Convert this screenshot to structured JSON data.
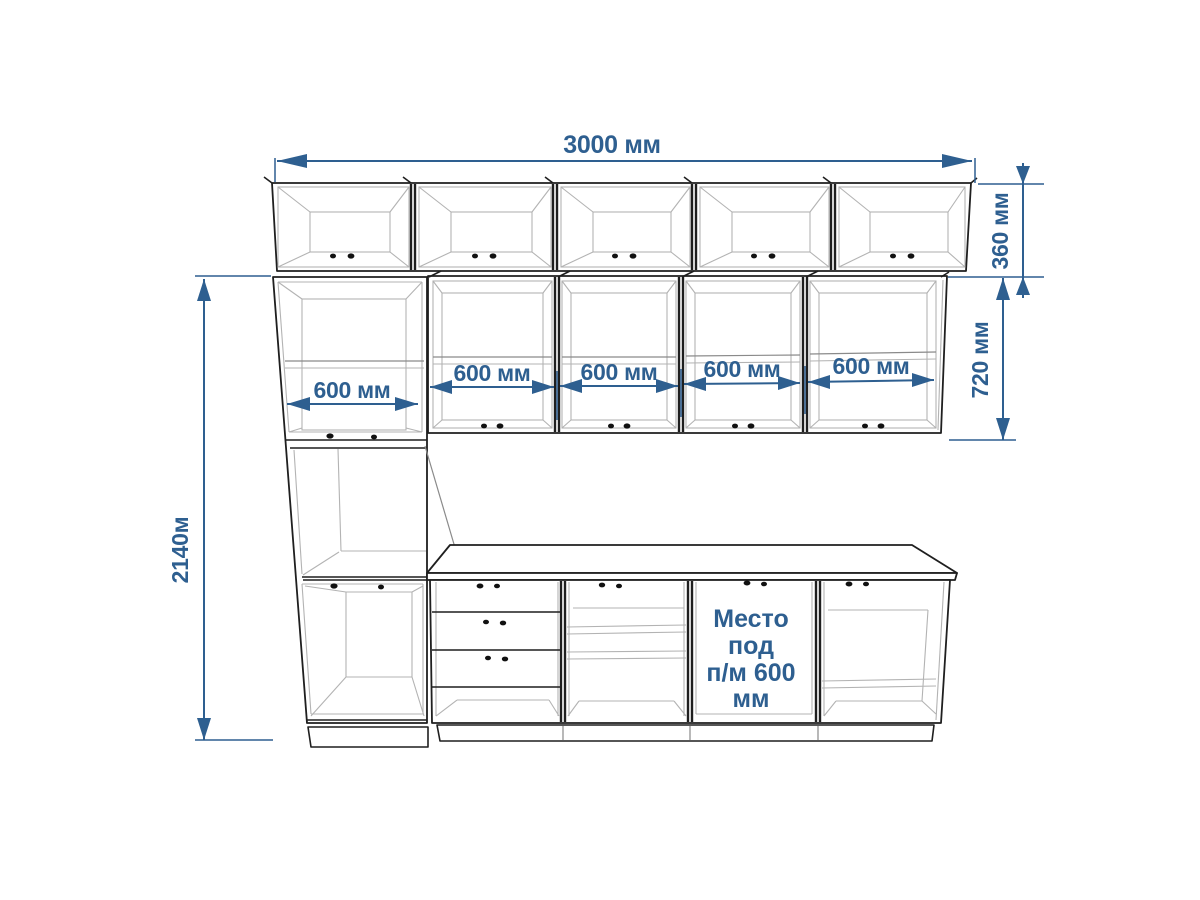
{
  "diagram": {
    "dimensions": {
      "total_width": "3000 мм",
      "upper_cabinet_height": "360 мм",
      "wall_cabinet_height": "720 мм",
      "total_height": "2140м",
      "unit_widths": [
        "600 мм",
        "600 мм",
        "600 мм",
        "600 мм",
        "600 мм"
      ]
    },
    "note": {
      "lines": [
        "Место",
        "под",
        "п/м 600",
        "мм"
      ]
    },
    "colors": {
      "dimension_blue": "#2e5f90",
      "outline": "#1f1f1f",
      "interior_line": "#b3b3b3",
      "background": "#ffffff"
    }
  }
}
